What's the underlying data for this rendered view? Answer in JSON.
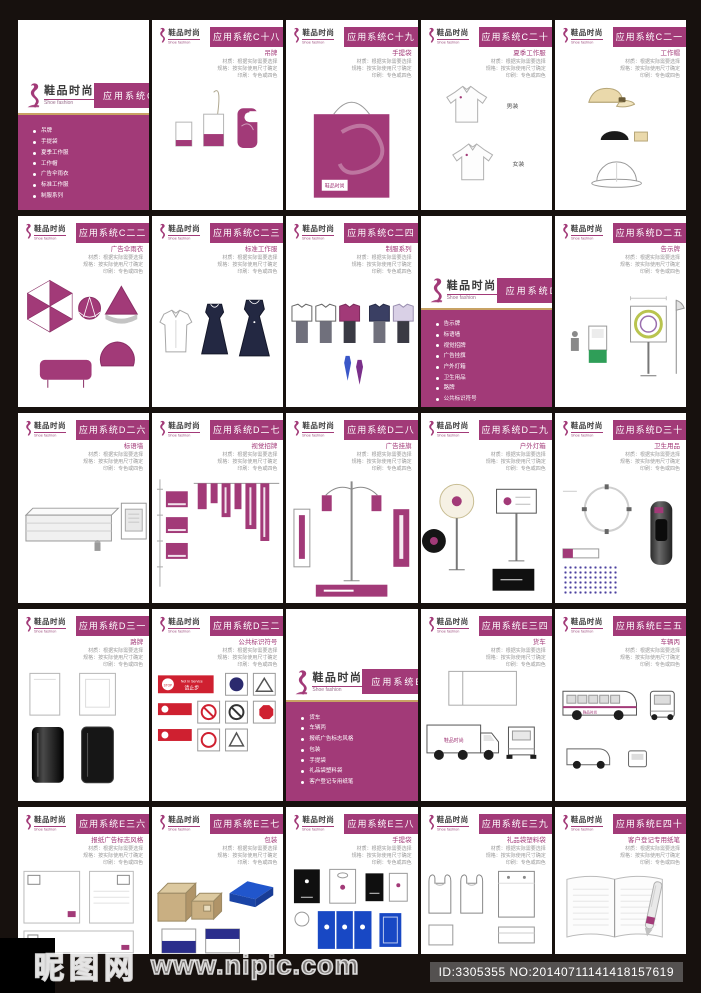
{
  "brand": {
    "name_cn": "鞋品时尚",
    "name_en": "Shoe fashion"
  },
  "page_note": {
    "line1": "材质：根据实际需要选择",
    "line2": "规格：按实际使用尺寸确定",
    "line3": "印刷：专色或四色"
  },
  "labels": {
    "menswear": "男装",
    "womenswear": "女装"
  },
  "signs": {
    "stop": "STOP",
    "not_in_service": "Not In Service",
    "keep_out": "请止步"
  },
  "colors": {
    "purple": "#a23a78",
    "gold": "#c8a264",
    "navy": "#2b2e8c",
    "blue": "#1848c4",
    "red": "#cf2030",
    "tan": "#c9af82"
  },
  "dividers": [
    {
      "title": "应用系统C",
      "items": [
        "吊牌",
        "手提袋",
        "夏季工作服",
        "工作帽",
        "广告伞雨衣",
        "标准工作服",
        "制服系列"
      ]
    },
    {
      "title": "应用系统D",
      "items": [
        "告示牌",
        "标语墙",
        "视觉招牌",
        "广告挂旗",
        "户外灯箱",
        "卫生用品",
        "路牌",
        "公共标识符号"
      ]
    },
    {
      "title": "应用系统E",
      "items": [
        "货车",
        "车辆丙",
        "报纸广告标志风格",
        "包装",
        "手提袋",
        "礼品袋塑料袋",
        "客户登记专用纸笔"
      ]
    }
  ],
  "pages": [
    {
      "title": "应用系统C十八",
      "subtitle": "吊牌"
    },
    {
      "title": "应用系统C十九",
      "subtitle": "手提袋"
    },
    {
      "title": "应用系统C二十",
      "subtitle": "夏季工作服"
    },
    {
      "title": "应用系统C二一",
      "subtitle": "工作帽"
    },
    {
      "title": "应用系统C二二",
      "subtitle": "广告伞雨衣"
    },
    {
      "title": "应用系统C二三",
      "subtitle": "标准工作服"
    },
    {
      "title": "应用系统C二四",
      "subtitle": "制服系列"
    },
    {
      "title": "应用系统D二五",
      "subtitle": "告示牌"
    },
    {
      "title": "应用系统D二六",
      "subtitle": "标语墙"
    },
    {
      "title": "应用系统D二七",
      "subtitle": "视觉招牌"
    },
    {
      "title": "应用系统D二八",
      "subtitle": "广告挂旗"
    },
    {
      "title": "应用系统D二九",
      "subtitle": "户外灯箱"
    },
    {
      "title": "应用系统D三十",
      "subtitle": "卫生用品"
    },
    {
      "title": "应用系统D三一",
      "subtitle": "路牌"
    },
    {
      "title": "应用系统D三二",
      "subtitle": "公共标识符号"
    },
    {
      "title": "应用系统E三四",
      "subtitle": "货车"
    },
    {
      "title": "应用系统E三五",
      "subtitle": "车辆丙"
    },
    {
      "title": "应用系统E三六",
      "subtitle": "报纸广告标志风格"
    },
    {
      "title": "应用系统E三七",
      "subtitle": "包装"
    },
    {
      "title": "应用系统E三八",
      "subtitle": "手提袋"
    },
    {
      "title": "应用系统E三九",
      "subtitle": "礼品袋塑料袋"
    },
    {
      "title": "应用系统E四十",
      "subtitle": "客户登记专用纸笔"
    }
  ],
  "watermark": {
    "site_name": "昵图网",
    "site_url": "www.nipic.com",
    "id_text": "ID:3305355 NO:20140711141418157619"
  }
}
